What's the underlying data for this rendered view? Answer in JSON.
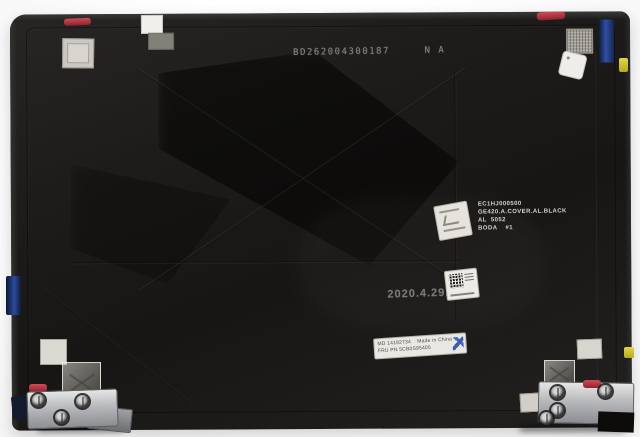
{
  "scene": {
    "description": "Laptop LCD back cover replacement part (inside view) photographed on a white background",
    "background_color": "#ffffff",
    "cover_color": "#1d1b19"
  },
  "markings": {
    "top_serial": "BD262004300187     N A",
    "mold_label": {
      "lines": [
        "EC1HJ000500",
        "GE420.A.COVER.AL.BLACK",
        "AL  5052",
        "BODA    #1"
      ]
    },
    "date_stamp": "2020.4.29.A1",
    "fru_label": {
      "line1": "MD 14192734    Made in China",
      "line2": "FRU PN 5CB0S95405"
    }
  },
  "stickers": {
    "small_white_sticker": "handwritten-marks",
    "qr_label": "qr-code",
    "blue_stamp_color": "#2b4ea6"
  },
  "palette": {
    "metal_hinge": "#b9babd",
    "tape_red": "#b03038",
    "antenna_blue": "#24418f",
    "tab_yellow": "#d7c832",
    "label_white": "#e8e6e1",
    "etched_text_gray": "#85827d"
  }
}
